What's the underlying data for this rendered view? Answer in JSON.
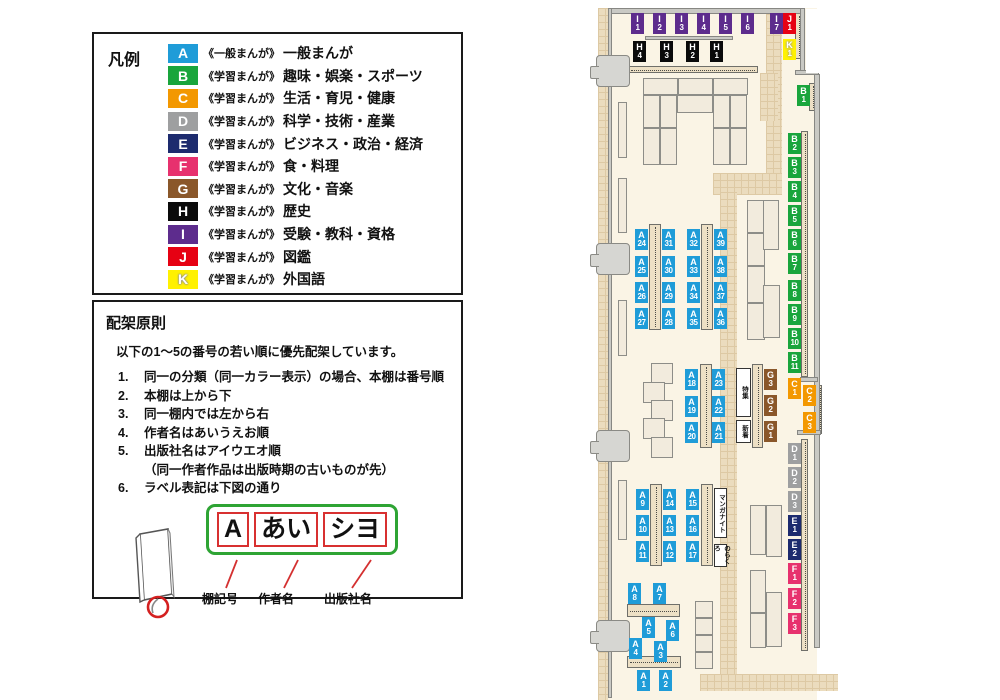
{
  "legend": {
    "title": "凡例",
    "items": [
      {
        "code": "A",
        "color": "#1f9cd8",
        "series": "《一般まんが》",
        "label": "一般まんが"
      },
      {
        "code": "B",
        "color": "#19a53c",
        "series": "《学習まんが》",
        "label": "趣味・娯楽・スポーツ"
      },
      {
        "code": "C",
        "color": "#f39801",
        "series": "《学習まんが》",
        "label": "生活・育児・健康"
      },
      {
        "code": "D",
        "color": "#9e9fa0",
        "series": "《学習まんが》",
        "label": "科学・技術・産業"
      },
      {
        "code": "E",
        "color": "#1d2b6e",
        "series": "《学習まんが》",
        "label": "ビジネス・政治・経済"
      },
      {
        "code": "F",
        "color": "#e7316e",
        "series": "《学習まんが》",
        "label": "食・料理"
      },
      {
        "code": "G",
        "color": "#8a572a",
        "series": "《学習まんが》",
        "label": "文化・音楽"
      },
      {
        "code": "H",
        "color": "#0a0a0a",
        "series": "《学習まんが》",
        "label": "歴史"
      },
      {
        "code": "I",
        "color": "#5d2c8d",
        "series": "《学習まんが》",
        "label": "受験・教科・資格"
      },
      {
        "code": "J",
        "color": "#e60113",
        "series": "《学習まんが》",
        "label": "図鑑"
      },
      {
        "code": "K",
        "color": "#fff101",
        "series": "《学習まんが》",
        "label": "外国語",
        "outlined": true
      }
    ]
  },
  "principles": {
    "title": "配架原則",
    "intro": "以下の1～5の番号の若い順に優先配架しています。",
    "rules": [
      {
        "num": "1.",
        "text": "同一の分類（同一カラー表示）の場合、本棚は番号順"
      },
      {
        "num": "2.",
        "text": "本棚は上から下"
      },
      {
        "num": "3.",
        "text": "同一棚内では左から右"
      },
      {
        "num": "4.",
        "text": "作者名はあいうえお順"
      },
      {
        "num": "5.",
        "text": "出版社名はアイウエオ順",
        "note": "（同一作者作品は出版時期の古いものが先）"
      },
      {
        "num": "6.",
        "text": "ラベル表記は下図の通り"
      }
    ],
    "label_example": {
      "cells": [
        "A",
        "あい",
        "シヨ"
      ],
      "captions": [
        "棚記号",
        "作者名",
        "出版社名"
      ]
    }
  },
  "map": {
    "signs": [
      {
        "text": "特集",
        "x": 736,
        "y": 368,
        "w": 15,
        "h": 49
      },
      {
        "text": "新着",
        "x": 736,
        "y": 420,
        "w": 15,
        "h": 23
      },
      {
        "text": "マンガナイト",
        "x": 714,
        "y": 488,
        "w": 13,
        "h": 50
      },
      {
        "text": "のらくろ",
        "x": 714,
        "y": 544,
        "w": 13,
        "h": 23
      }
    ],
    "labels": [
      {
        "id": "I1",
        "letter": "I",
        "num": "1",
        "x": 631,
        "y": 13
      },
      {
        "id": "I2",
        "letter": "I",
        "num": "2",
        "x": 653,
        "y": 13
      },
      {
        "id": "I3",
        "letter": "I",
        "num": "3",
        "x": 675,
        "y": 13
      },
      {
        "id": "I4",
        "letter": "I",
        "num": "4",
        "x": 697,
        "y": 13
      },
      {
        "id": "I5",
        "letter": "I",
        "num": "5",
        "x": 719,
        "y": 13
      },
      {
        "id": "I6",
        "letter": "I",
        "num": "6",
        "x": 741,
        "y": 13
      },
      {
        "id": "I7",
        "letter": "I",
        "num": "7",
        "x": 770,
        "y": 13
      },
      {
        "id": "J1",
        "letter": "J",
        "num": "1",
        "x": 783,
        "y": 13
      },
      {
        "id": "K1",
        "letter": "K",
        "num": "1",
        "x": 783,
        "y": 39
      },
      {
        "id": "H4",
        "letter": "H",
        "num": "4",
        "x": 633,
        "y": 41
      },
      {
        "id": "H3",
        "letter": "H",
        "num": "3",
        "x": 660,
        "y": 41
      },
      {
        "id": "H2",
        "letter": "H",
        "num": "2",
        "x": 686,
        "y": 41
      },
      {
        "id": "H1",
        "letter": "H",
        "num": "1",
        "x": 710,
        "y": 41
      },
      {
        "id": "B1",
        "letter": "B",
        "num": "1",
        "x": 797,
        "y": 85
      },
      {
        "id": "B2",
        "letter": "B",
        "num": "2",
        "x": 788,
        "y": 133
      },
      {
        "id": "B3",
        "letter": "B",
        "num": "3",
        "x": 788,
        "y": 157
      },
      {
        "id": "B4",
        "letter": "B",
        "num": "4",
        "x": 788,
        "y": 181
      },
      {
        "id": "B5",
        "letter": "B",
        "num": "5",
        "x": 788,
        "y": 205
      },
      {
        "id": "B6",
        "letter": "B",
        "num": "6",
        "x": 788,
        "y": 229
      },
      {
        "id": "B7",
        "letter": "B",
        "num": "7",
        "x": 788,
        "y": 253
      },
      {
        "id": "B8",
        "letter": "B",
        "num": "8",
        "x": 788,
        "y": 280
      },
      {
        "id": "B9",
        "letter": "B",
        "num": "9",
        "x": 788,
        "y": 304
      },
      {
        "id": "B10",
        "letter": "B",
        "num": "10",
        "x": 788,
        "y": 328
      },
      {
        "id": "B11",
        "letter": "B",
        "num": "11",
        "x": 788,
        "y": 352
      },
      {
        "id": "C1",
        "letter": "C",
        "num": "1",
        "x": 788,
        "y": 378
      },
      {
        "id": "C2",
        "letter": "C",
        "num": "2",
        "x": 803,
        "y": 385
      },
      {
        "id": "C3",
        "letter": "C",
        "num": "3",
        "x": 803,
        "y": 412
      },
      {
        "id": "D1",
        "letter": "D",
        "num": "1",
        "x": 788,
        "y": 443
      },
      {
        "id": "D2",
        "letter": "D",
        "num": "2",
        "x": 788,
        "y": 467
      },
      {
        "id": "D3",
        "letter": "D",
        "num": "3",
        "x": 788,
        "y": 491
      },
      {
        "id": "E1",
        "letter": "E",
        "num": "1",
        "x": 788,
        "y": 515
      },
      {
        "id": "E2",
        "letter": "E",
        "num": "2",
        "x": 788,
        "y": 539
      },
      {
        "id": "F1",
        "letter": "F",
        "num": "1",
        "x": 788,
        "y": 563
      },
      {
        "id": "F2",
        "letter": "F",
        "num": "2",
        "x": 788,
        "y": 588
      },
      {
        "id": "F3",
        "letter": "F",
        "num": "3",
        "x": 788,
        "y": 613
      },
      {
        "id": "G3",
        "letter": "G",
        "num": "3",
        "x": 764,
        "y": 369
      },
      {
        "id": "G2",
        "letter": "G",
        "num": "2",
        "x": 764,
        "y": 395
      },
      {
        "id": "G1",
        "letter": "G",
        "num": "1",
        "x": 764,
        "y": 421
      },
      {
        "id": "A24",
        "letter": "A",
        "num": "24",
        "x": 635,
        "y": 229
      },
      {
        "id": "A25",
        "letter": "A",
        "num": "25",
        "x": 635,
        "y": 256
      },
      {
        "id": "A26",
        "letter": "A",
        "num": "26",
        "x": 635,
        "y": 282
      },
      {
        "id": "A27",
        "letter": "A",
        "num": "27",
        "x": 635,
        "y": 308
      },
      {
        "id": "A31",
        "letter": "A",
        "num": "31",
        "x": 662,
        "y": 229
      },
      {
        "id": "A30",
        "letter": "A",
        "num": "30",
        "x": 662,
        "y": 256
      },
      {
        "id": "A29",
        "letter": "A",
        "num": "29",
        "x": 662,
        "y": 282
      },
      {
        "id": "A28",
        "letter": "A",
        "num": "28",
        "x": 662,
        "y": 308
      },
      {
        "id": "A32",
        "letter": "A",
        "num": "32",
        "x": 687,
        "y": 229
      },
      {
        "id": "A33",
        "letter": "A",
        "num": "33",
        "x": 687,
        "y": 256
      },
      {
        "id": "A34",
        "letter": "A",
        "num": "34",
        "x": 687,
        "y": 282
      },
      {
        "id": "A35",
        "letter": "A",
        "num": "35",
        "x": 687,
        "y": 308
      },
      {
        "id": "A39",
        "letter": "A",
        "num": "39",
        "x": 714,
        "y": 229
      },
      {
        "id": "A38",
        "letter": "A",
        "num": "38",
        "x": 714,
        "y": 256
      },
      {
        "id": "A37",
        "letter": "A",
        "num": "37",
        "x": 714,
        "y": 282
      },
      {
        "id": "A36",
        "letter": "A",
        "num": "36",
        "x": 714,
        "y": 308
      },
      {
        "id": "A18",
        "letter": "A",
        "num": "18",
        "x": 685,
        "y": 369
      },
      {
        "id": "A19",
        "letter": "A",
        "num": "19",
        "x": 685,
        "y": 396
      },
      {
        "id": "A20",
        "letter": "A",
        "num": "20",
        "x": 685,
        "y": 422
      },
      {
        "id": "A23",
        "letter": "A",
        "num": "23",
        "x": 712,
        "y": 369
      },
      {
        "id": "A22",
        "letter": "A",
        "num": "22",
        "x": 712,
        "y": 396
      },
      {
        "id": "A21",
        "letter": "A",
        "num": "21",
        "x": 712,
        "y": 422
      },
      {
        "id": "A9",
        "letter": "A",
        "num": "9",
        "x": 636,
        "y": 489
      },
      {
        "id": "A10",
        "letter": "A",
        "num": "10",
        "x": 636,
        "y": 515
      },
      {
        "id": "A11",
        "letter": "A",
        "num": "11",
        "x": 636,
        "y": 541
      },
      {
        "id": "A14",
        "letter": "A",
        "num": "14",
        "x": 663,
        "y": 489
      },
      {
        "id": "A13",
        "letter": "A",
        "num": "13",
        "x": 663,
        "y": 515
      },
      {
        "id": "A12",
        "letter": "A",
        "num": "12",
        "x": 663,
        "y": 541
      },
      {
        "id": "A15",
        "letter": "A",
        "num": "15",
        "x": 686,
        "y": 489
      },
      {
        "id": "A16",
        "letter": "A",
        "num": "16",
        "x": 686,
        "y": 515
      },
      {
        "id": "A17",
        "letter": "A",
        "num": "17",
        "x": 686,
        "y": 541
      },
      {
        "id": "A8",
        "letter": "A",
        "num": "8",
        "x": 628,
        "y": 583
      },
      {
        "id": "A7",
        "letter": "A",
        "num": "7",
        "x": 653,
        "y": 583
      },
      {
        "id": "A5",
        "letter": "A",
        "num": "5",
        "x": 642,
        "y": 617
      },
      {
        "id": "A6",
        "letter": "A",
        "num": "6",
        "x": 666,
        "y": 620
      },
      {
        "id": "A4",
        "letter": "A",
        "num": "4",
        "x": 629,
        "y": 638
      },
      {
        "id": "A3",
        "letter": "A",
        "num": "3",
        "x": 654,
        "y": 641
      },
      {
        "id": "A1",
        "letter": "A",
        "num": "1",
        "x": 637,
        "y": 670
      },
      {
        "id": "A2",
        "letter": "A",
        "num": "2",
        "x": 659,
        "y": 670
      }
    ]
  }
}
